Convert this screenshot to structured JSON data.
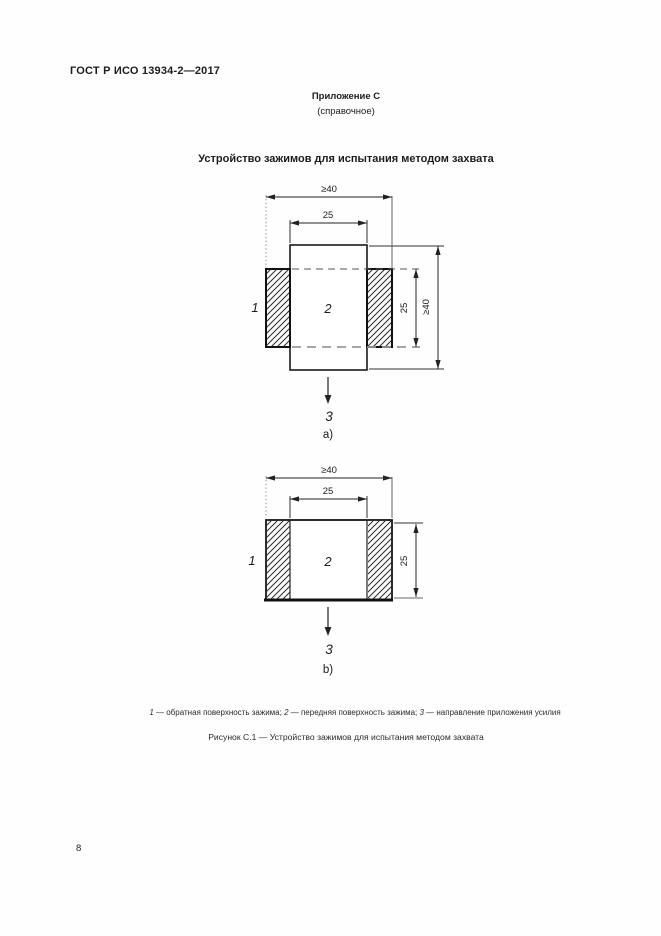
{
  "colors": {
    "ink": "#1c1c1c",
    "grey_line": "#9a9a9a"
  },
  "header": {
    "standard_ref": "ГОСТ Р ИСО 13934-2—2017"
  },
  "appendix": {
    "label": "Приложение С",
    "note": "(справочное)"
  },
  "title": "Устройство зажимов для испытания методом захвата",
  "drawing_a": {
    "dim_width_outer": "≥40",
    "dim_width_inner": "25",
    "dim_height_inner": "25",
    "dim_height_outer": "≥40",
    "label_clamp_back": "1",
    "label_clamp_front": "2",
    "label_force": "3",
    "sublabel": "a)"
  },
  "drawing_b": {
    "dim_width_outer": "≥40",
    "dim_width_inner": "25",
    "dim_height": "25",
    "label_clamp_back": "1",
    "label_clamp_front": "2",
    "label_force": "3",
    "sublabel": "b)"
  },
  "legend": {
    "ref1": "1",
    "text1": " — обратная поверхность зажима; ",
    "ref2": "2",
    "text2": " — передняя поверхность зажима; ",
    "ref3": "3",
    "text3": " — направление приложения усилия"
  },
  "caption": "Рисунок С.1 — Устройство зажимов для испытания методом захвата",
  "footer": {
    "page_number": "8"
  }
}
